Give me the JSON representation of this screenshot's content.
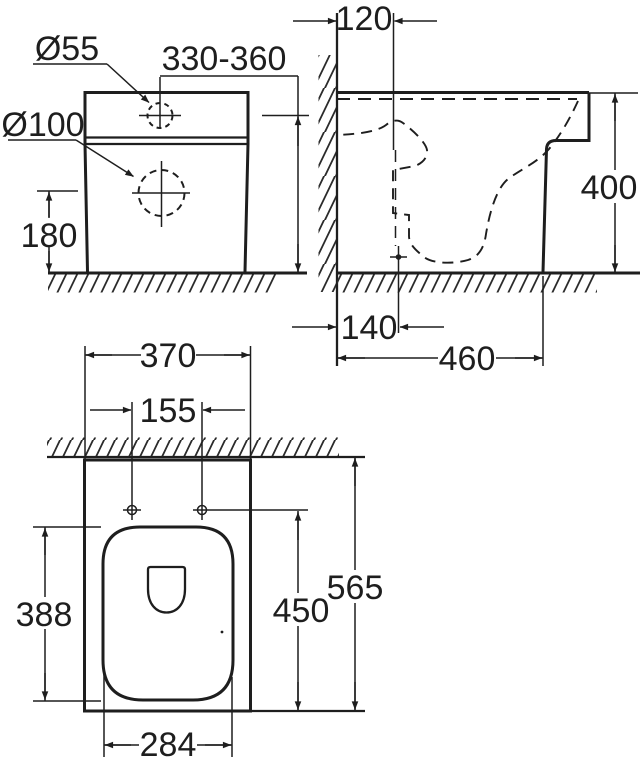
{
  "drawing": {
    "title": "toilet-installation-dimension-drawing",
    "background_color": "#ffffff",
    "line_color": "#1e1e1e",
    "views": {
      "front": {
        "name": "front view",
        "labels": {
          "hole_small": "Ø55",
          "hole_large": "Ø100",
          "supply_height_range": "330-360",
          "drain_height": "180"
        }
      },
      "side": {
        "name": "side view",
        "labels": {
          "supply_wall_offset": "120",
          "overall_height": "400",
          "drain_wall_offset": "140",
          "overall_depth": "460"
        }
      },
      "plan": {
        "name": "plan view",
        "labels": {
          "overall_width": "370",
          "bolt_hole_spacing": "155",
          "seat_opening_length": "388",
          "bolt_hole_depth": "450",
          "total_depth": "565",
          "seat_opening_width": "284"
        }
      }
    }
  }
}
